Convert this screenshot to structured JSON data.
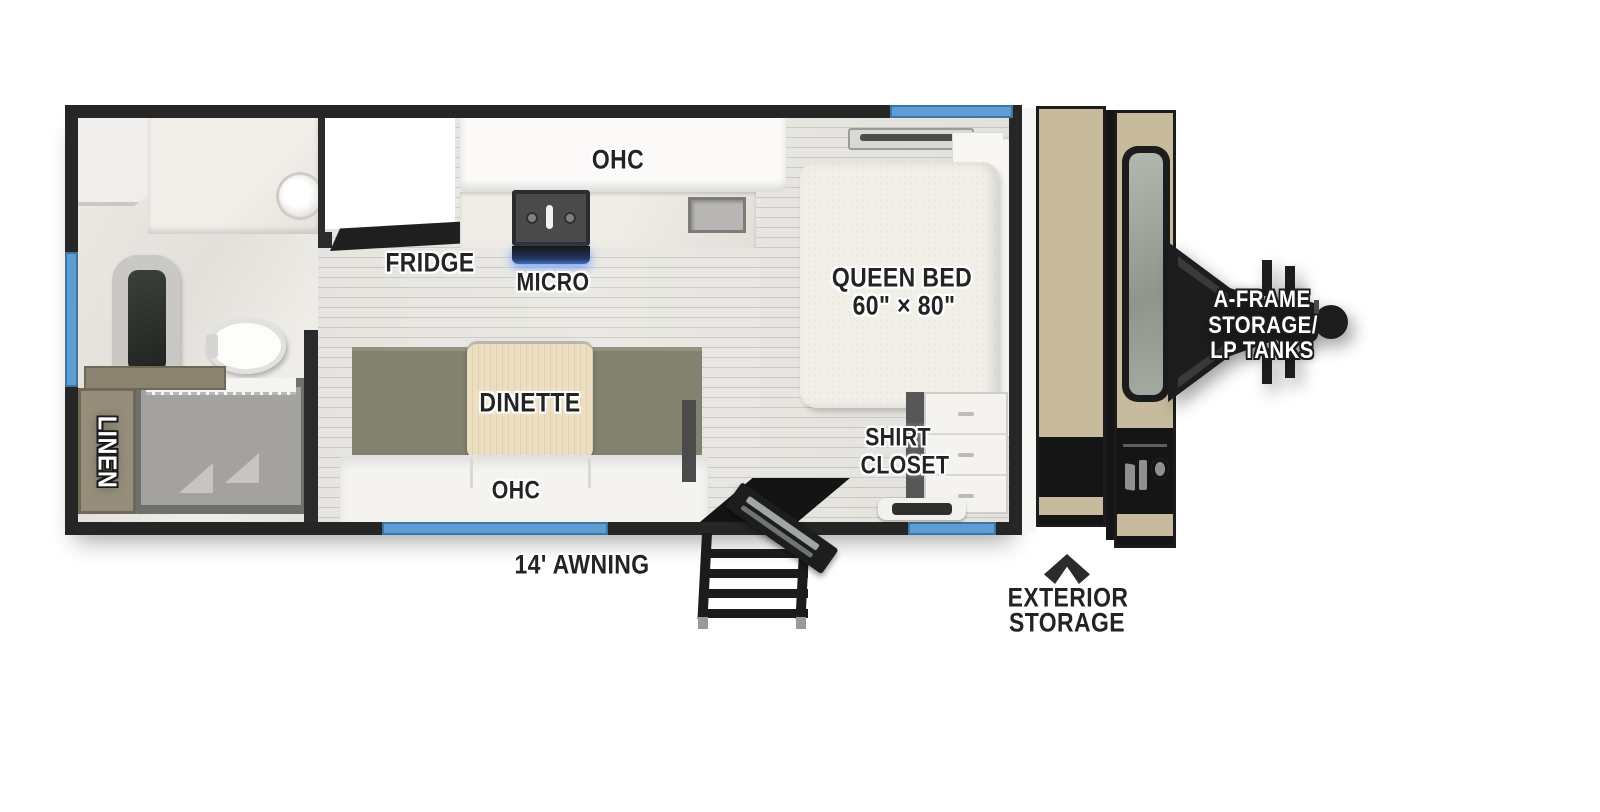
{
  "labels": {
    "ohc_kitchen": "OHC",
    "fridge": "FRIDGE",
    "micro": "MICRO",
    "queen_bed_line1": "QUEEN BED",
    "queen_bed_line2": "60\" × 80\"",
    "dinette": "DINETTE",
    "ohc_sofa": "OHC",
    "linen": "LINEN",
    "shirt_closet_line1": "SHIRT",
    "shirt_closet_line2": "CLOSET",
    "awning": "14' AWNING",
    "exterior_storage_line1": "EXTERIOR",
    "exterior_storage_line2": "STORAGE",
    "aframe_line1": "A-FRAME",
    "aframe_line2": "STORAGE/",
    "aframe_line3": "LP TANKS"
  },
  "colors": {
    "window_blue": "#5d9fd4",
    "wall_black": "#262626",
    "cap_tan": "#c8bb9d",
    "bench_olive": "#83816f",
    "table_wood": "#ecdfc1",
    "linen_cabinet": "#968e7a",
    "micro_glow": "#3f6fc0",
    "label_dark": "#232323"
  },
  "icons": {
    "up_arrow": "chevron-up-icon",
    "hitch": "a-frame-hitch-icon"
  }
}
